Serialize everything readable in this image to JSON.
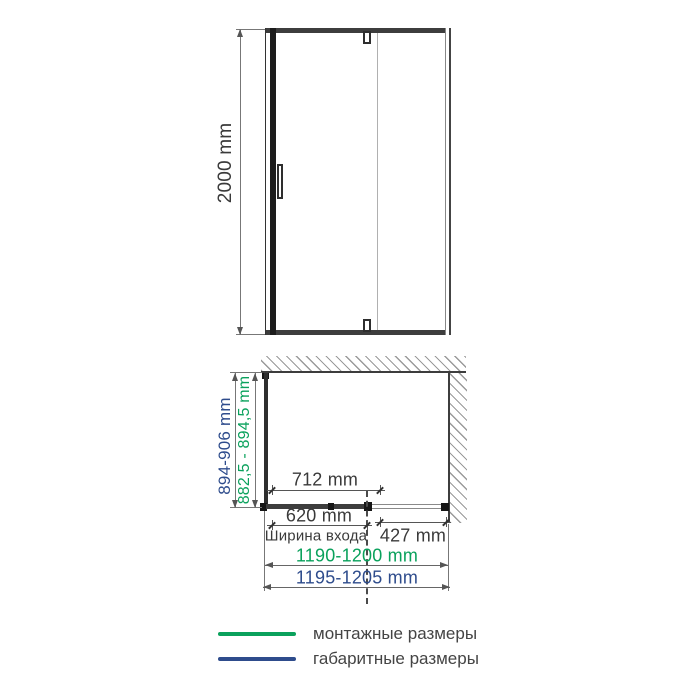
{
  "front_view": {
    "height_dimension": "2000 mm"
  },
  "plan_view": {
    "depth_overall": "894-906 mm",
    "depth_mounting": "882,5 - 894,5 mm",
    "door_panel_width": "712 mm",
    "entry_width": "620 mm",
    "entry_width_caption": "Ширина входа",
    "fixed_panel_width": "427 mm",
    "width_mounting": "1190-1200 mm",
    "width_overall": "1195-1205 mm"
  },
  "legend": {
    "mounting": {
      "label": "монтажные размеры",
      "color": "#0aa15c"
    },
    "overall": {
      "label": "габаритные размеры",
      "color": "#2e4c8c"
    }
  },
  "colors": {
    "mounting_green": "#0aa15c",
    "overall_blue": "#2e4c8c",
    "line_dark": "#3d3d3d"
  }
}
